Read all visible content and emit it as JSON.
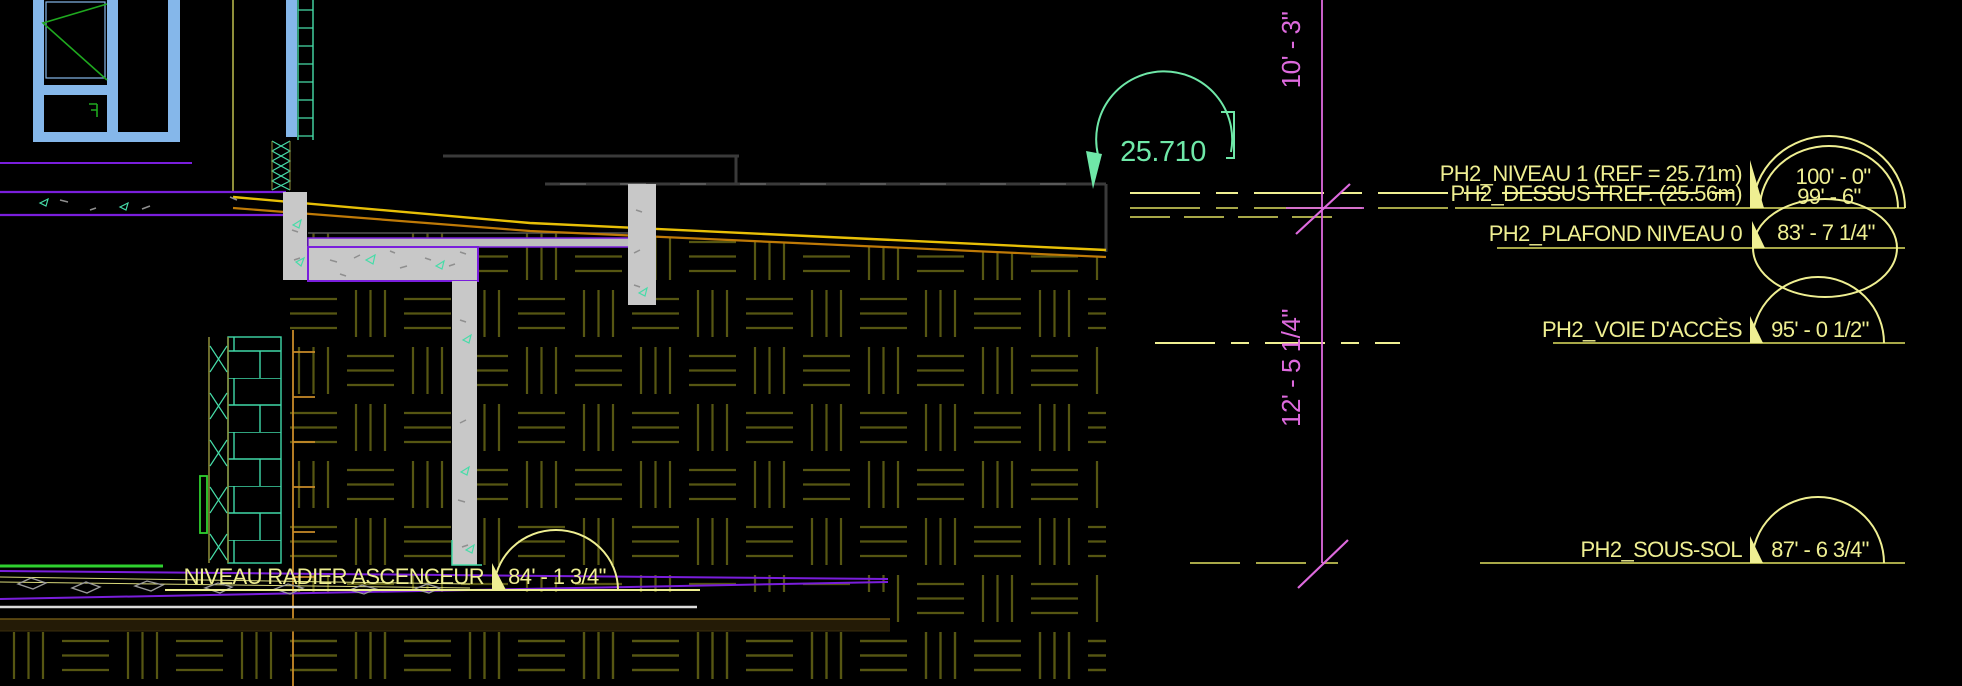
{
  "drawing": {
    "elevation_marker": {
      "value": "25.710"
    },
    "vertical_dimensions": {
      "upper": "10' - 3\"",
      "lower": "12' - 5 1/4\""
    },
    "levels": [
      {
        "label": "PH2_NIVEAU 1 (REF = 25.71m)",
        "value": "100' - 0\""
      },
      {
        "label": "PH2_DESSUS TREF. (25.56m)",
        "value": "99' - 6\""
      },
      {
        "label": "PH2_PLAFOND NIVEAU 0",
        "value": "83' - 7 1/4\""
      },
      {
        "label": "PH2_VOIE D'ACCÈS",
        "value": "95' - 0 1/2\""
      },
      {
        "label": "PH2_SOUS-SOL",
        "value": "87' - 6 3/4\""
      },
      {
        "label": "NIVEAU RADIER ASCENCEUR",
        "value": "84' - 1 3/4\""
      }
    ],
    "colors": {
      "background": "#000000",
      "annotation_yellow": "#EFEF92",
      "level_line_olive": "#A8A848",
      "dimension_magenta": "#DE6ADE",
      "elevation_green": "#6FE8A8",
      "hatch_olive": "#565612",
      "slope_yellow": "#E8C007",
      "slope_orange": "#BF7A07",
      "window_blue": "#85B7EA",
      "casement_green": "#1FA81F",
      "bright_green": "#2FD02F",
      "concrete_gray": "#C8C8C8",
      "concrete_tick_teal": "#46DCA8",
      "slab_purple": "#7A1EDC"
    }
  }
}
